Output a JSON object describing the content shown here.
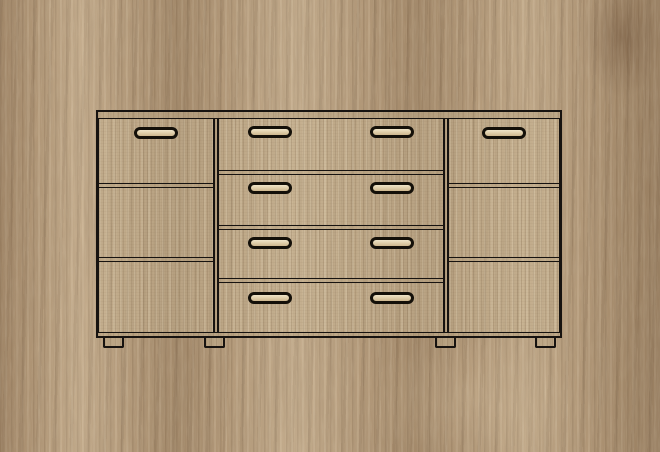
{
  "scene": {
    "type": "furniture-product-illustration",
    "description": "Front-view line drawing of a three-section oak sideboard with four center drawers, shown on a Sonoma oak woodgrain background",
    "background_material": "sonoma-oak-woodgrain"
  },
  "palette": {
    "wood_base": "#b29878",
    "wood_light": "#cdb795",
    "wood_dark": "#8f775c",
    "cabinet_wood": "#c3ad8c",
    "outline": "#171310",
    "handle_slot": "#e7dab8"
  },
  "cabinet": {
    "label": "Sideboard with two doors and four drawers",
    "handle_style": "recessed pill handle",
    "top": {
      "label": "Top board"
    },
    "plinth": {
      "label": "Plinth board"
    },
    "feet": {
      "count": 4,
      "label": "Cabinet foot"
    },
    "sections": {
      "left": {
        "label": "Left door",
        "panel_count": 3,
        "handle_count": 1
      },
      "center": {
        "label": "Center drawer stack",
        "drawer_count": 4,
        "handles_per_drawer": 2,
        "drawers": [
          {
            "label": "Drawer 1"
          },
          {
            "label": "Drawer 2"
          },
          {
            "label": "Drawer 3"
          },
          {
            "label": "Drawer 4"
          }
        ]
      },
      "right": {
        "label": "Right door",
        "panel_count": 3,
        "handle_count": 1
      }
    }
  }
}
